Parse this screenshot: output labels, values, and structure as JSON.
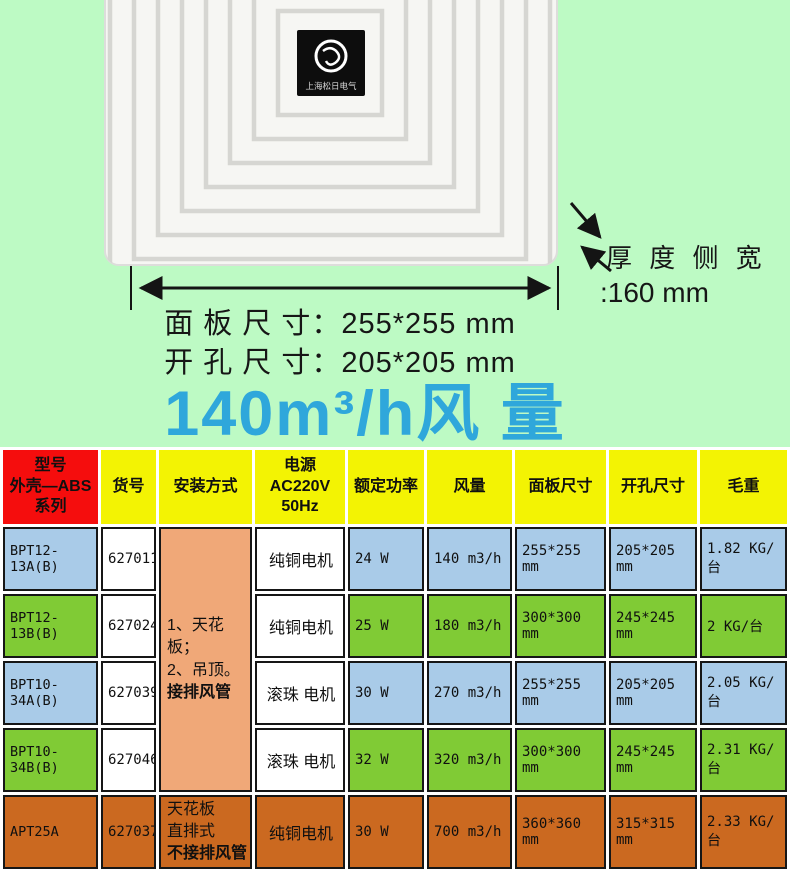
{
  "colors": {
    "page_green": "#bdfac4",
    "accent_blue": "#2fa7db",
    "header_red": "#f50d0d",
    "header_yellow": "#f3f303",
    "row_blue": "#a9cbe8",
    "row_green": "#80cb35",
    "row_orange": "#cb6920",
    "install_salmon": "#f0a878"
  },
  "hero": {
    "logo_brand": "上海松日电气",
    "panel_size_label": "面 板 尺 寸：255*255 mm",
    "hole_size_label": "开 孔 尺 寸：205*205 mm",
    "thickness_label": "厚 度 侧 宽",
    "thickness_value": ":160 mm",
    "airflow_headline": "140m³/h风 量"
  },
  "table": {
    "headers": [
      "型号\n外壳—ABS\n系列",
      "货号",
      "安装方式",
      "电源\nAC220V\n50Hz",
      "额定功率",
      "风量",
      "面板尺寸",
      "开孔尺寸",
      "毛重"
    ],
    "install_merged": {
      "lines": [
        "1、天花板；",
        "2、吊顶。"
      ],
      "bold_line": "接排风管"
    },
    "rows": [
      {
        "model": "BPT12-13A(B)",
        "sku": "627011",
        "motor": "纯铜电机",
        "power": "24 W",
        "airflow": "140 m3/h",
        "panel": "255*255 mm",
        "hole": "205*205 mm",
        "weight": "1.82 KG/台",
        "tone": "blue"
      },
      {
        "model": "BPT12-13B(B)",
        "sku": "627024",
        "motor": "纯铜电机",
        "power": "25 W",
        "airflow": "180 m3/h",
        "panel": "300*300 mm",
        "hole": "245*245 mm",
        "weight": "2 KG/台",
        "tone": "green"
      },
      {
        "model": "BPT10-34A(B)",
        "sku": "627039",
        "motor": "滚珠 电机",
        "power": "30 W",
        "airflow": "270 m3/h",
        "panel": "255*255 mm",
        "hole": "205*205 mm",
        "weight": "2.05 KG/台",
        "tone": "blue"
      },
      {
        "model": "BPT10-34B(B)",
        "sku": "627046",
        "motor": "滚珠 电机",
        "power": "32 W",
        "airflow": "320 m3/h",
        "panel": "300*300 mm",
        "hole": "245*245 mm",
        "weight": "2.31 KG/台",
        "tone": "green"
      },
      {
        "model": "APT25A",
        "sku": "627037",
        "install_lines": [
          "天花板",
          "直排式"
        ],
        "install_bold": "不接排风管",
        "motor": "纯铜电机",
        "power": "30 W",
        "airflow": "700 m3/h",
        "panel": "360*360 mm",
        "hole": "315*315 mm",
        "weight": "2.33 KG/台",
        "tone": "orange"
      }
    ]
  }
}
